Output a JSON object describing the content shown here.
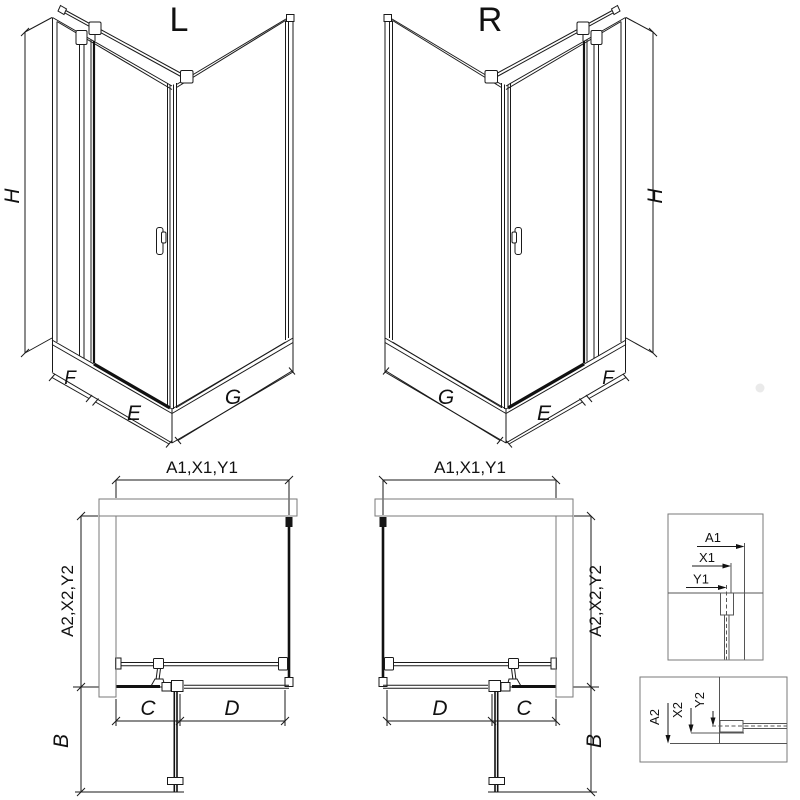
{
  "iso_left": {
    "label": "L",
    "dim_height": "H",
    "dim_f": "F",
    "dim_e": "E",
    "dim_g": "G"
  },
  "iso_right": {
    "label": "R",
    "dim_height": "H",
    "dim_f": "F",
    "dim_e": "E",
    "dim_g": "G"
  },
  "plan_left": {
    "dim_width": "A1,X1,Y1",
    "dim_depth": "A2,X2,Y2",
    "dim_c": "C",
    "dim_d": "D",
    "dim_b": "B"
  },
  "plan_right": {
    "dim_width": "A1,X1,Y1",
    "dim_depth": "A2,X2,Y2",
    "dim_c": "C",
    "dim_d": "D",
    "dim_b": "B"
  },
  "detail_top": {
    "dim_a": "A1",
    "dim_x": "X1",
    "dim_y": "Y1"
  },
  "detail_bottom": {
    "dim_a": "A2",
    "dim_x": "X2",
    "dim_y": "Y2"
  },
  "colors": {
    "line": "#1a1a1a",
    "dark": "#111111",
    "gray": "#7a7a7a",
    "hatch": "#4a4a4a"
  }
}
